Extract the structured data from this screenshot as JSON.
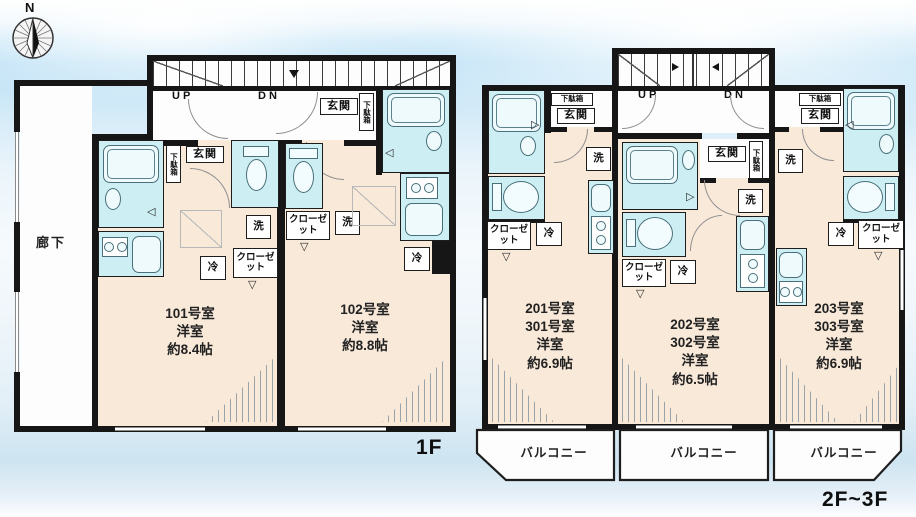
{
  "colors": {
    "room_fill": "#f9e9d9",
    "wet_fill": "#cdeef3",
    "wall": "#161616",
    "sky_band": "#b9dff5"
  },
  "compass": {
    "north": "N"
  },
  "shared": {
    "corridor": "廊下",
    "up": "UP",
    "dn": "DN",
    "genkan": "玄関",
    "getabako": "下駄箱",
    "washer": "洗",
    "fridge": "冷",
    "closet": "クローゼット",
    "balcony": "バルコニー"
  },
  "floor1": {
    "caption": "1F",
    "units": [
      {
        "lines": [
          "101号室",
          "洋室",
          "約8.4帖"
        ]
      },
      {
        "lines": [
          "102号室",
          "洋室",
          "約8.8帖"
        ]
      }
    ]
  },
  "floor23": {
    "caption": "2F~3F",
    "units": [
      {
        "lines": [
          "201号室",
          "301号室",
          "洋室",
          "約6.9帖"
        ]
      },
      {
        "lines": [
          "202号室",
          "302号室",
          "洋室",
          "約6.5帖"
        ]
      },
      {
        "lines": [
          "203号室",
          "303号室",
          "洋室",
          "約6.9帖"
        ]
      }
    ],
    "balconies": [
      "バルコニー",
      "バルコニー",
      "バルコニー"
    ]
  }
}
